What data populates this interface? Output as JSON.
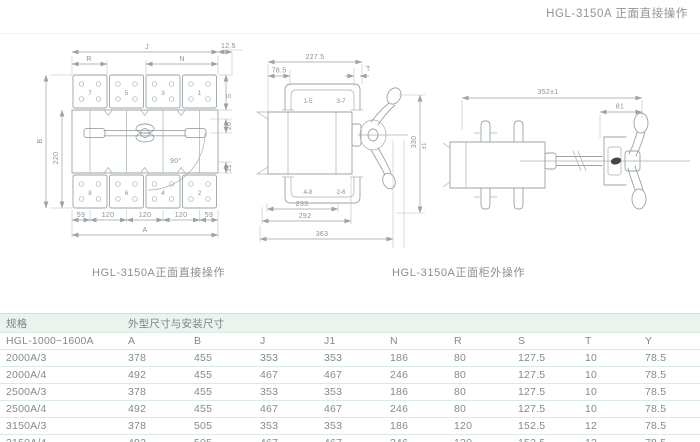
{
  "page": {
    "title": "HGL-3150A 正面直接操作"
  },
  "front_view": {
    "caption": "HGL-3150A正面直接操作",
    "terminals_top": [
      "7",
      "5",
      "3",
      "1"
    ],
    "terminals_bottom": [
      "8",
      "6",
      "4",
      "2"
    ],
    "dim_j": "J",
    "dim_r": "R",
    "dim_n": "N",
    "dim_12_5": "12.5",
    "dim_s": "S",
    "dim_26": "26",
    "dim_11": "11",
    "dim_b": "B",
    "dim_220": "220",
    "dim_angle": "90°",
    "bottom_dims": [
      "59",
      "120",
      "120",
      "120",
      "59"
    ],
    "dim_a": "A"
  },
  "side_view": {
    "caption": "HGL-3150A正面柜外操作",
    "dim_227_5": "227.5",
    "dim_78_5": "78.5",
    "dim_t": "T",
    "pole_labels_top": [
      "1-5",
      "3-7"
    ],
    "pole_labels_bottom": [
      "4-8",
      "2-6"
    ],
    "dim_233": "233",
    "dim_292": "292",
    "dim_363": "363",
    "dim_330": "330",
    "dim_330_tol": "±1"
  },
  "external_view": {
    "dim_352": "352±1",
    "dim_81": "81"
  },
  "table": {
    "col_spec": "规格",
    "col_dims_group": "外型尺寸与安装尺寸",
    "sub_header": [
      "HGL-1000~1600A",
      "A",
      "B",
      "J",
      "J1",
      "N",
      "R",
      "S",
      "T",
      "Y"
    ],
    "rows": [
      [
        "2000A/3",
        "378",
        "455",
        "353",
        "353",
        "186",
        "80",
        "127.5",
        "10",
        "78.5"
      ],
      [
        "2000A/4",
        "492",
        "455",
        "467",
        "467",
        "246",
        "80",
        "127.5",
        "10",
        "78.5"
      ],
      [
        "2500A/3",
        "378",
        "455",
        "353",
        "353",
        "186",
        "80",
        "127.5",
        "10",
        "78.5"
      ],
      [
        "2500A/4",
        "492",
        "455",
        "467",
        "467",
        "246",
        "80",
        "127.5",
        "10",
        "78.5"
      ],
      [
        "3150A/3",
        "378",
        "505",
        "353",
        "353",
        "186",
        "120",
        "152.5",
        "12",
        "78.5"
      ],
      [
        "3150A/4",
        "492",
        "505",
        "467",
        "467",
        "246",
        "120",
        "152.5",
        "12",
        "78.5"
      ]
    ]
  }
}
